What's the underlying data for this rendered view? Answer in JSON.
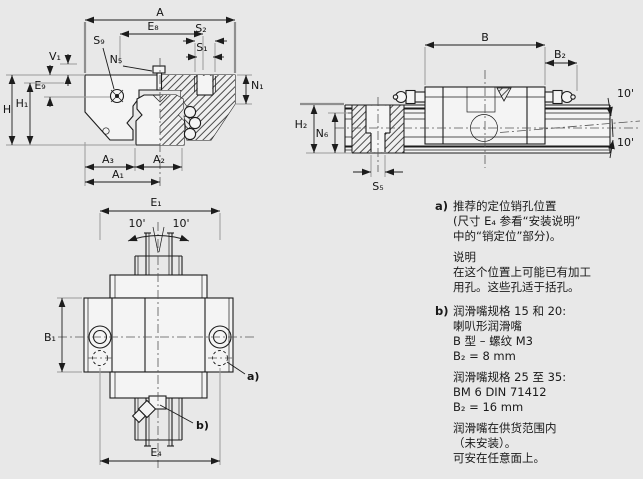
{
  "colors": {
    "background": "#e8e8e8",
    "object_line": "#1c1c1c",
    "extension_line": "#9a9a9a",
    "part_fill": "#f4f4f4"
  },
  "views": {
    "cross_section": {
      "labels": {
        "A": "A",
        "E8": "E₈",
        "S2": "S₂",
        "S1": "S₁",
        "S9": "S₉",
        "N5": "N₅",
        "V1": "V₁",
        "E9": "E₉",
        "H": "H",
        "H1": "H₁",
        "N1": "N₁",
        "A3": "A₃",
        "A2": "A₂",
        "A1": "A₁"
      }
    },
    "side": {
      "labels": {
        "B": "B",
        "B2": "B₂",
        "H2": "H₂",
        "N6": "N₆",
        "S5": "S₅",
        "angle_top": "10'",
        "angle_bottom": "10'"
      }
    },
    "plan": {
      "labels": {
        "E1": "E₁",
        "E4": "E₄",
        "B1": "B₁",
        "angle_left": "10'",
        "angle_right": "10'",
        "callout_a": "a)",
        "callout_b": "b)"
      }
    }
  },
  "notes": {
    "a": {
      "marker": "a)",
      "lines": [
        "推荐的定位销孔位置",
        "(尺寸 E₄ 参看“安装说明”",
        "中的“销定位”部分)。"
      ],
      "remark_title": "说明",
      "remark_lines": [
        "在这个位置上可能已有加工",
        "用孔。这些孔适于括孔。"
      ]
    },
    "b": {
      "marker": "b)",
      "group1": [
        "润滑嘴规格 15 和 20:",
        "喇叭形润滑嘴",
        "B 型 – 螺纹 M3",
        "B₂ = 8 mm"
      ],
      "group2": [
        "润滑嘴规格 25 至 35:",
        "BM 6 DIN 71412",
        "B₂ = 16 mm"
      ],
      "group3": [
        "润滑嘴在供货范围内",
        "（未安装）。",
        "可安在任意面上。"
      ]
    }
  }
}
